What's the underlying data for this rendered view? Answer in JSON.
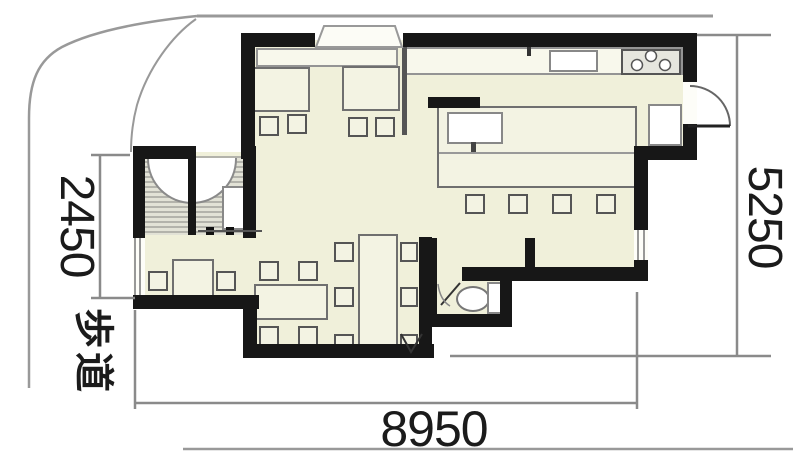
{
  "drawing": {
    "type": "architectural-floor-plan",
    "dimensions": {
      "left_mm": "2450",
      "right_mm": "5250",
      "bottom_mm": "8950"
    },
    "labels": {
      "sidewalk": "歩道"
    },
    "icons": {
      "stove": "stove-burners-icon (3 white circles)",
      "toilet": "toilet-icon (bowl oval + tank rect)",
      "door_swing": "quarter/half circle arc",
      "sink": "white rectangle with faucet tick"
    },
    "colors": {
      "floor": "#f0f0da",
      "wall": "#171717",
      "boundary_line": "#999999",
      "dimension_line": "#8a8a8a",
      "hatch": "#b3b3ab"
    }
  }
}
